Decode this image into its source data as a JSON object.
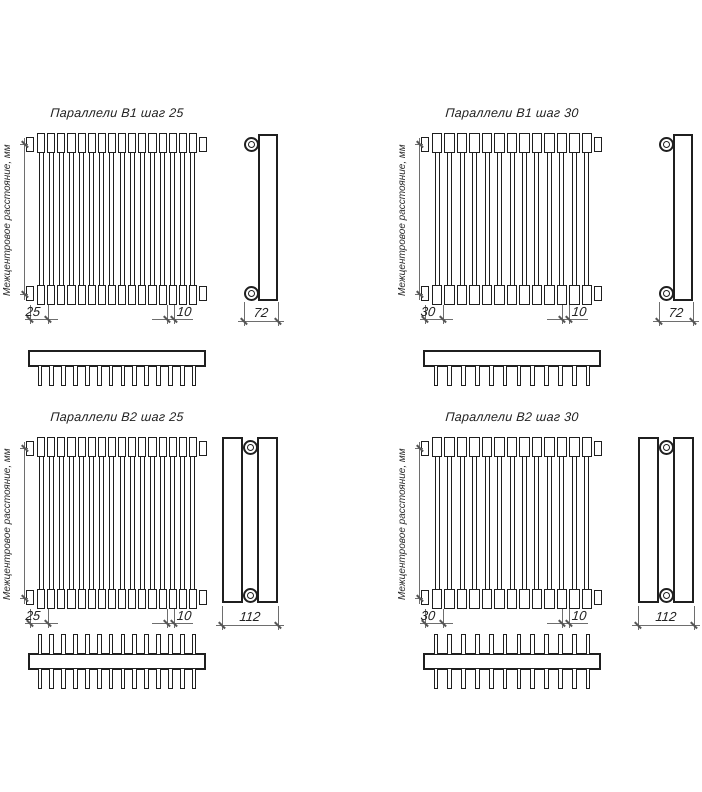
{
  "drawing": {
    "left_axis_label": "Межцентровое расстояние, мм",
    "line_color": "#1f1f1f",
    "dim_color": "#6e6e6e",
    "panels": [
      {
        "title": "Параллели В1 шаг 25",
        "rows": 1,
        "tubes": 16,
        "comb_teeth": 14,
        "dims": {
          "step": "25",
          "end": "10",
          "depth": "72"
        }
      },
      {
        "title": "Параллели В1 шаг 30",
        "rows": 1,
        "tubes": 13,
        "comb_teeth": 12,
        "dims": {
          "step": "30",
          "end": "10",
          "depth": "72"
        }
      },
      {
        "title": "Параллели В2 шаг 25",
        "rows": 2,
        "tubes": 16,
        "comb_teeth": 14,
        "dims": {
          "step": "25",
          "end": "10",
          "depth": "112"
        }
      },
      {
        "title": "Параллели В2 шаг 30",
        "rows": 2,
        "tubes": 13,
        "comb_teeth": 12,
        "dims": {
          "step": "30",
          "end": "10",
          "depth": "112"
        }
      }
    ]
  }
}
